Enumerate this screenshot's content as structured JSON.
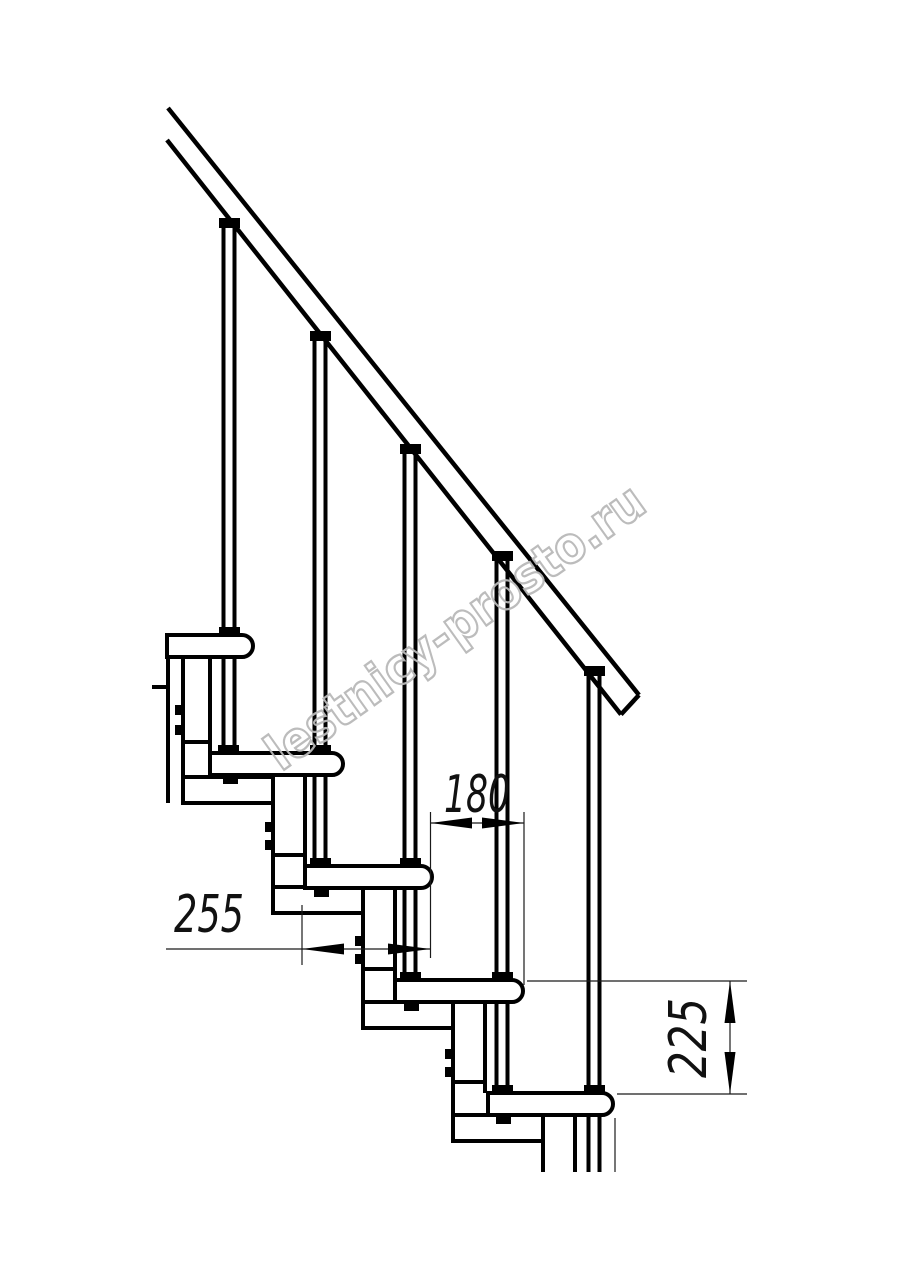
{
  "drawing": {
    "title": "modular-staircase-side-view",
    "watermark": "lestnicy-prosto.ru",
    "dimensions": {
      "step_run": "180",
      "tread_depth": "255",
      "step_rise": "225"
    },
    "colors": {
      "line": "#000000",
      "thin_line": "#1a1a1a",
      "watermark": "#b9b9b9",
      "background": "#ffffff"
    }
  }
}
